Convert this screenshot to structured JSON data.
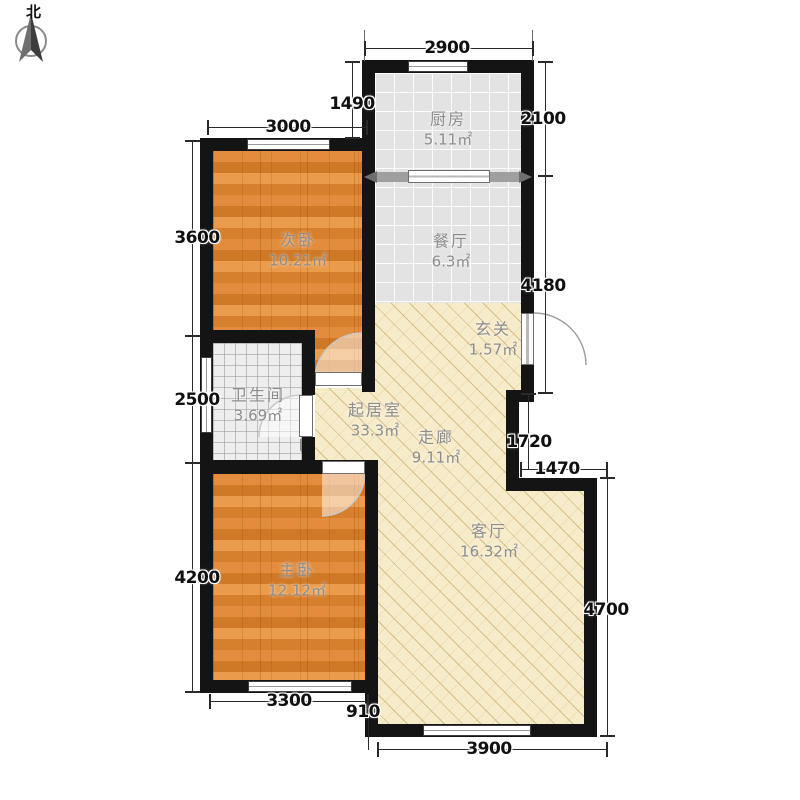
{
  "compass": {
    "label": "北"
  },
  "rooms": [
    {
      "name": "厨房",
      "area": "5.11㎡"
    },
    {
      "name": "餐厅",
      "area": "6.3㎡"
    },
    {
      "name": "玄关",
      "area": "1.57㎡"
    },
    {
      "name": "次卧",
      "area": "10.21㎡"
    },
    {
      "name": "卫生间",
      "area": "3.69㎡"
    },
    {
      "name": "起居室",
      "area": "33.3㎡"
    },
    {
      "name": "走廊",
      "area": "9.11㎡"
    },
    {
      "name": "客厅",
      "area": "16.32㎡"
    },
    {
      "name": "主卧",
      "area": "12.12㎡"
    }
  ],
  "dimensions": {
    "kitchen_width": "2900",
    "kitchen_left_offset": "1490",
    "second_bedroom_width": "3000",
    "kitchen_depth": "2100",
    "second_bedroom_depth": "3600",
    "dining_entry_depth": "4180",
    "bathroom_depth": "2500",
    "corridor_step_depth": "1720",
    "living_step_width": "1470",
    "master_bedroom_depth": "4200",
    "living_room_depth": "4700",
    "master_bedroom_width": "3300",
    "bottom_offset": "910",
    "living_room_width": "3900"
  }
}
